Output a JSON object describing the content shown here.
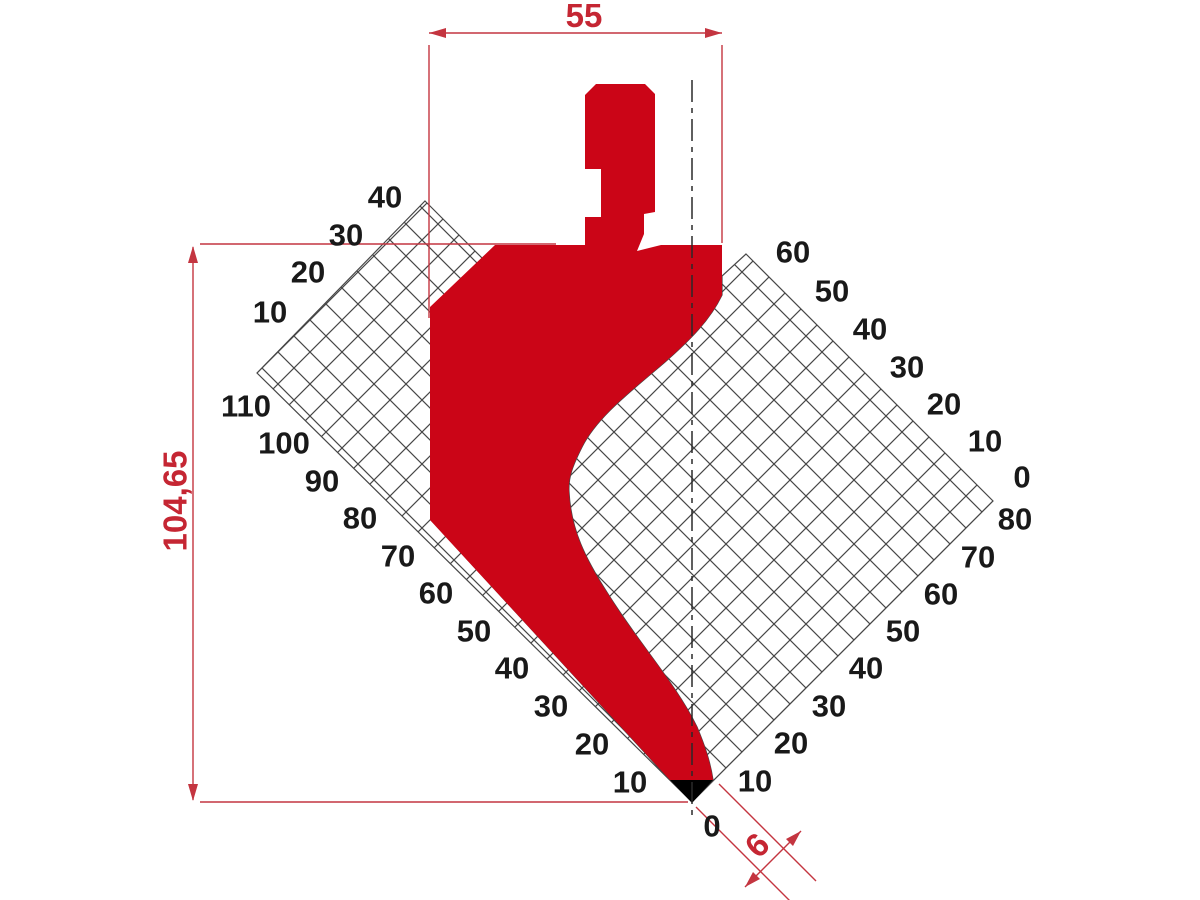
{
  "drawing": {
    "kind": "press-brake punch profile",
    "background": "#ffffff"
  },
  "colors": {
    "punch_red": "#cb0517",
    "dimension_red": "#c43540",
    "hatch_line": "#474747",
    "label_black": "#191919",
    "tip_black": "#000000"
  },
  "geometry": {
    "left_grid": "M425,201 L483,259 L431,310 L431,520 L670,780 L692,802 L257,373 Z",
    "right_grid": "M746,254 L993,501 L692,802 L713,780 C710,760 704,744 697,727 C676,684 640,645 608,594 C585,558 571,530 569,492 C568,477 573,465 582,447 C597,417 630,392 665,362 C690,340 710,320 722,295 L722,276 Z",
    "red_shape": "M596,84 L645,84 L655,94 L655,212 L644,214 L644,234 L637,251 L661,245 L722,245 L722,295 C710,320 690,340 665,362 C630,392 597,417 582,447 C573,465 568,477 569,492 C571,530 585,558 608,594 C640,645 676,684 697,727 C704,744 710,760 713,780 L670,780 L430,520 L430,307 L495,245 L585,245 L585,217 L601,217 L601,169 L585,169 L585,95 Z",
    "tip_triangle": "M670,780 L713,780 L692,803 Z",
    "centerline": "M692,80 L692,820"
  },
  "dimensions": {
    "width": {
      "label": "55",
      "line": "M429,33 L722,33",
      "arrows": "M429,33 L446,28 L446,38 Z M722,33 L705,28 L705,38 Z",
      "ext": "M429,45 L429,318 M722,45 L722,243"
    },
    "height": {
      "label": "104,65",
      "line": "M193,247 L193,800",
      "arrows": "M193,246 L188,263 L198,263 Z M193,801 L188,784 L198,784 Z",
      "ext": "M200,244 L556,244 M200,802 L688,802"
    },
    "tip_width": {
      "label": "6",
      "line": "M745,887 L801,831",
      "arrows": "M745,887 L760,879 L753,872 Z M801,831 L786,839 L793,846 Z",
      "ext": "M696,807 L798,909 M719,784 L816,881"
    }
  },
  "scales": {
    "left_upper": [
      {
        "t": "40",
        "x": 385,
        "y": 197
      },
      {
        "t": "30",
        "x": 346,
        "y": 235
      },
      {
        "t": "20",
        "x": 308,
        "y": 272
      },
      {
        "t": "10",
        "x": 270,
        "y": 312
      }
    ],
    "left_lower": [
      {
        "t": "110",
        "x": 246,
        "y": 406
      },
      {
        "t": "100",
        "x": 284,
        "y": 443
      },
      {
        "t": "90",
        "x": 322,
        "y": 481
      },
      {
        "t": "80",
        "x": 360,
        "y": 518
      },
      {
        "t": "70",
        "x": 398,
        "y": 556
      },
      {
        "t": "60",
        "x": 436,
        "y": 593
      },
      {
        "t": "50",
        "x": 474,
        "y": 631
      },
      {
        "t": "40",
        "x": 512,
        "y": 668
      },
      {
        "t": "30",
        "x": 551,
        "y": 706
      },
      {
        "t": "20",
        "x": 592,
        "y": 744
      },
      {
        "t": "10",
        "x": 630,
        "y": 782
      }
    ],
    "bottom_zero": {
      "t": "0",
      "x": 712,
      "y": 826
    },
    "right_upper": [
      {
        "t": "60",
        "x": 793,
        "y": 252
      },
      {
        "t": "50",
        "x": 832,
        "y": 291
      },
      {
        "t": "40",
        "x": 870,
        "y": 329
      },
      {
        "t": "30",
        "x": 907,
        "y": 367
      },
      {
        "t": "20",
        "x": 944,
        "y": 404
      },
      {
        "t": "10",
        "x": 985,
        "y": 441
      },
      {
        "t": "0",
        "x": 1022,
        "y": 477
      }
    ],
    "right_lower": [
      {
        "t": "80",
        "x": 1015,
        "y": 519
      },
      {
        "t": "70",
        "x": 978,
        "y": 557
      },
      {
        "t": "60",
        "x": 941,
        "y": 594
      },
      {
        "t": "50",
        "x": 903,
        "y": 631
      },
      {
        "t": "40",
        "x": 866,
        "y": 668
      },
      {
        "t": "30",
        "x": 829,
        "y": 706
      },
      {
        "t": "20",
        "x": 791,
        "y": 743
      },
      {
        "t": "10",
        "x": 755,
        "y": 781
      }
    ]
  }
}
